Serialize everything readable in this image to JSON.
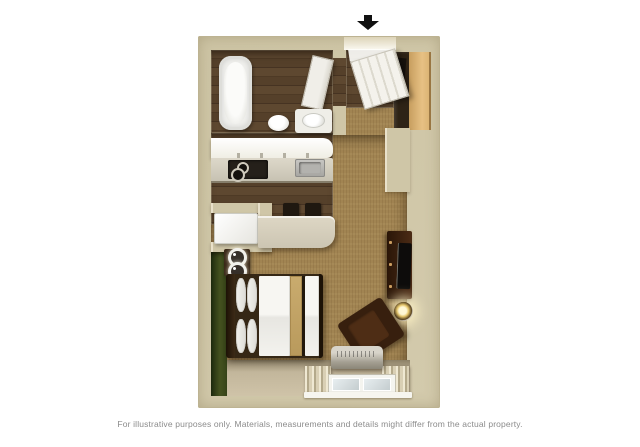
{
  "caption": "For illustrative purposes only.  Materials, measurements and details might differ from the actual property.",
  "entrance": {
    "icon": "down-arrow",
    "meaning": "unit entrance",
    "color": "#111111"
  },
  "palette": {
    "page_background": "#ffffff",
    "wall_beige": "#cfc6a7",
    "wall_highlight": "#ece4cf",
    "wood_floor_dark": "#54402a",
    "carpet_brown": "#a18452",
    "accent_wall_green": "#44511f",
    "counter_beige": "#d8d1bf",
    "linen_white": "#f4f3ef",
    "bed_runner_tan": "#c2a367",
    "furniture_dark_wood": "#3f2413",
    "caption_gray": "#8b8b8b"
  }
}
